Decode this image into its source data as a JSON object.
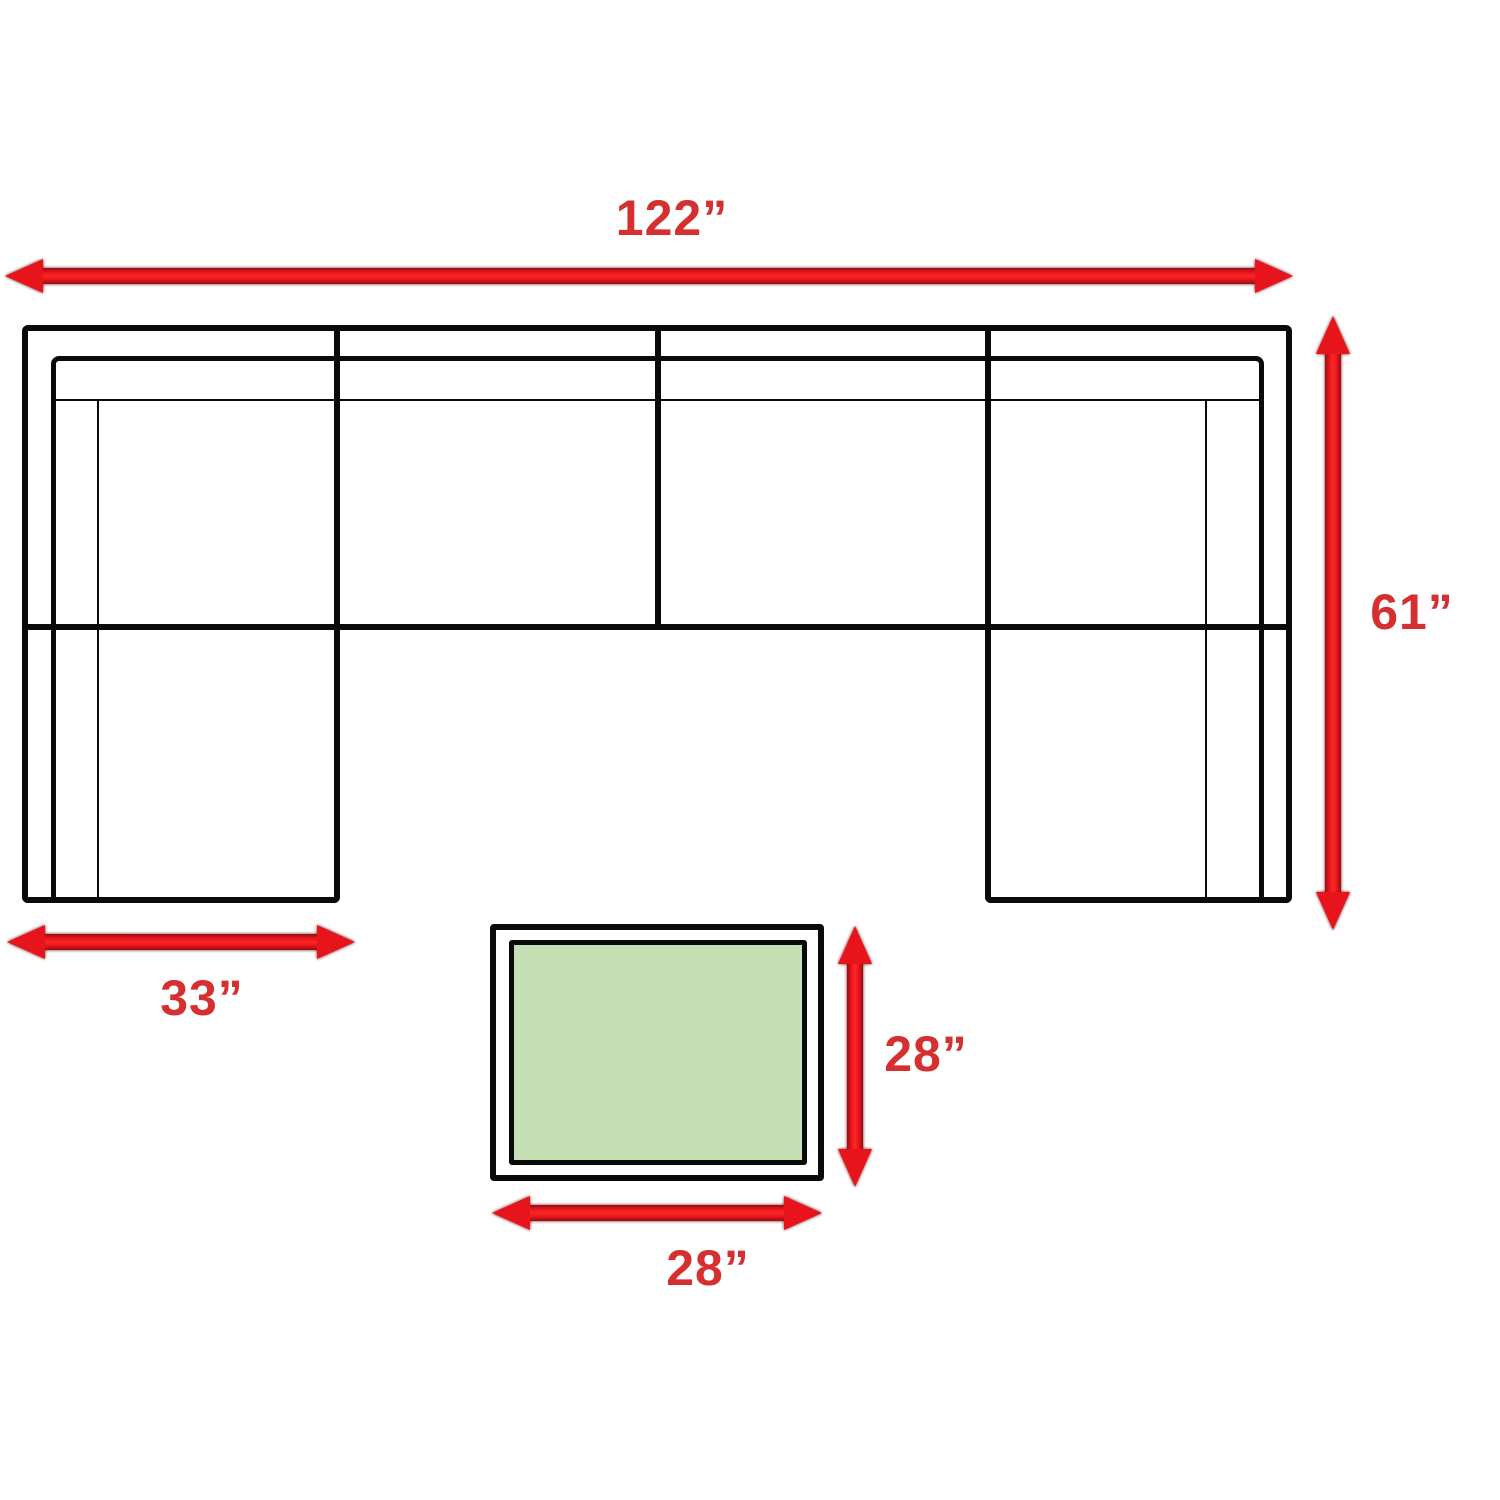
{
  "diagram": {
    "type": "furniture-dimension-diagram",
    "subject": "U-shaped sectional sofa with coffee table, top view",
    "dimensions": {
      "sofa_width": "122”",
      "sofa_depth": "61”",
      "chaise_width": "33”",
      "table_depth": "28”",
      "table_width": "28”"
    }
  },
  "colors": {
    "arrow_red": "#e8141b",
    "arrow_red_dark": "#8f0f12",
    "label_red": "#d62f2f",
    "table_green": "#c5e0b4",
    "ink": "#0a0a0a",
    "bg": "#ffffff"
  }
}
